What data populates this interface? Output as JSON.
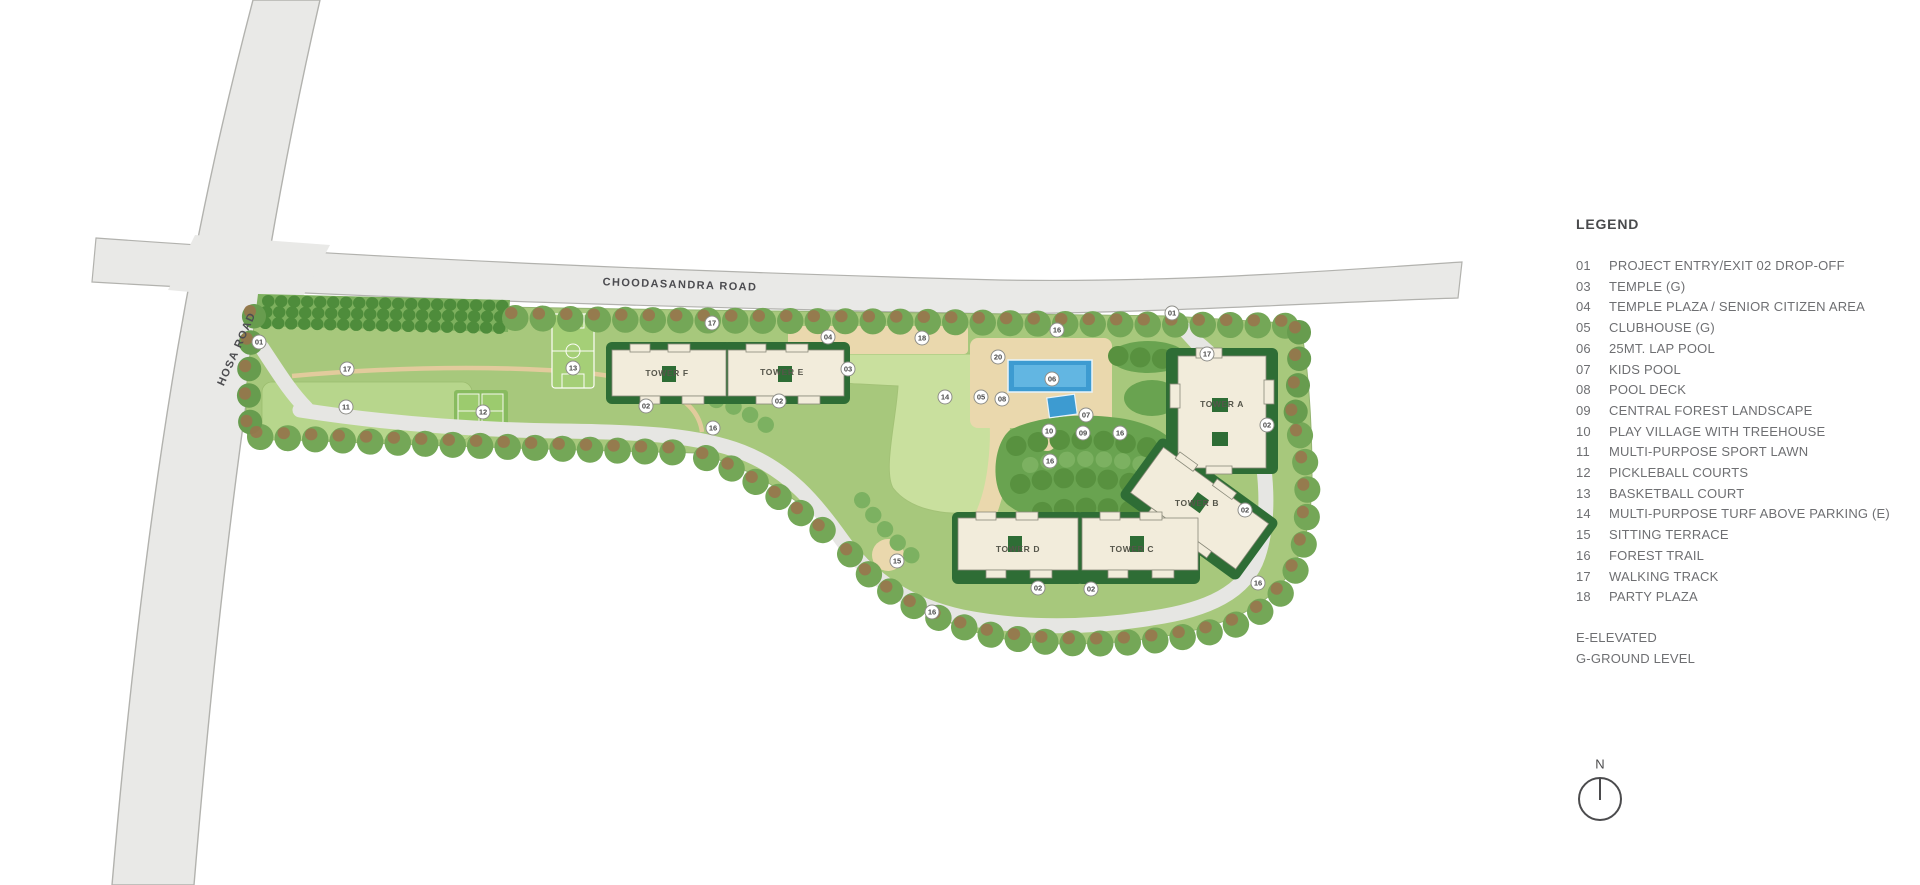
{
  "legend": {
    "title": "LEGEND",
    "items": [
      {
        "num": "01",
        "label": "PROJECT ENTRY/EXIT 02 DROP-OFF"
      },
      {
        "num": "03",
        "label": "TEMPLE (G)"
      },
      {
        "num": "04",
        "label": "TEMPLE PLAZA / SENIOR CITIZEN AREA"
      },
      {
        "num": "05",
        "label": "CLUBHOUSE (G)"
      },
      {
        "num": "06",
        "label": "25MT. LAP POOL"
      },
      {
        "num": "07",
        "label": "KIDS POOL"
      },
      {
        "num": "08",
        "label": "POOL DECK"
      },
      {
        "num": "09",
        "label": "CENTRAL FOREST LANDSCAPE"
      },
      {
        "num": "10",
        "label": "PLAY VILLAGE WITH TREEHOUSE"
      },
      {
        "num": "11",
        "label": "MULTI-PURPOSE SPORT LAWN"
      },
      {
        "num": "12",
        "label": "PICKLEBALL COURTS"
      },
      {
        "num": "13",
        "label": "BASKETBALL COURT"
      },
      {
        "num": "14",
        "label": "MULTI-PURPOSE TURF ABOVE PARKING (E)"
      },
      {
        "num": "15",
        "label": "SITTING TERRACE"
      },
      {
        "num": "16",
        "label": "FOREST TRAIL"
      },
      {
        "num": "17",
        "label": "WALKING TRACK"
      },
      {
        "num": "18",
        "label": "PARTY PLAZA"
      }
    ],
    "notes": [
      "E-ELEVATED",
      "G-GROUND LEVEL"
    ]
  },
  "map": {
    "roads": {
      "top": "CHOODASANDRA ROAD",
      "left": "HOSA ROAD"
    },
    "towers": {
      "a": "TOWER A",
      "b": "TOWER B",
      "c": "TOWER C",
      "d": "TOWER D",
      "e": "TOWER E",
      "f": "TOWER F"
    },
    "north_label": "N",
    "markers": [
      {
        "n": "01",
        "x": 259,
        "y": 342
      },
      {
        "n": "17",
        "x": 347,
        "y": 369
      },
      {
        "n": "11",
        "x": 346,
        "y": 407
      },
      {
        "n": "12",
        "x": 483,
        "y": 412
      },
      {
        "n": "13",
        "x": 573,
        "y": 368
      },
      {
        "n": "02",
        "x": 646,
        "y": 406
      },
      {
        "n": "02",
        "x": 779,
        "y": 401
      },
      {
        "n": "16",
        "x": 713,
        "y": 428
      },
      {
        "n": "17",
        "x": 712,
        "y": 323
      },
      {
        "n": "04",
        "x": 828,
        "y": 337
      },
      {
        "n": "03",
        "x": 848,
        "y": 369
      },
      {
        "n": "18",
        "x": 922,
        "y": 338
      },
      {
        "n": "14",
        "x": 945,
        "y": 397
      },
      {
        "n": "05",
        "x": 981,
        "y": 397
      },
      {
        "n": "20",
        "x": 998,
        "y": 357
      },
      {
        "n": "06",
        "x": 1052,
        "y": 379
      },
      {
        "n": "08",
        "x": 1002,
        "y": 399
      },
      {
        "n": "07",
        "x": 1086,
        "y": 415
      },
      {
        "n": "10",
        "x": 1049,
        "y": 431
      },
      {
        "n": "09",
        "x": 1083,
        "y": 433
      },
      {
        "n": "16",
        "x": 1120,
        "y": 433
      },
      {
        "n": "16",
        "x": 1057,
        "y": 330
      },
      {
        "n": "16",
        "x": 1050,
        "y": 461
      },
      {
        "n": "01",
        "x": 1172,
        "y": 313
      },
      {
        "n": "17",
        "x": 1207,
        "y": 354
      },
      {
        "n": "02",
        "x": 1267,
        "y": 425
      },
      {
        "n": "02",
        "x": 1245,
        "y": 510
      },
      {
        "n": "16",
        "x": 1258,
        "y": 583
      },
      {
        "n": "02",
        "x": 1038,
        "y": 588
      },
      {
        "n": "02",
        "x": 1091,
        "y": 589
      },
      {
        "n": "15",
        "x": 897,
        "y": 561
      },
      {
        "n": "16",
        "x": 932,
        "y": 612
      }
    ],
    "colors": {
      "road_gray": "#e9e9e7",
      "site_green": "#a7c87c",
      "forest_green": "#69a350",
      "turf_green": "#c9e09e",
      "lawn_green": "#b7d68c",
      "deck_tan": "#ead8ad",
      "pool_blue": "#3d9bd1",
      "building_cream": "#f2ecdb",
      "building_trim_green": "#2e6d35",
      "tree_green": "#74a757",
      "tree_brown": "#9e714c"
    }
  }
}
